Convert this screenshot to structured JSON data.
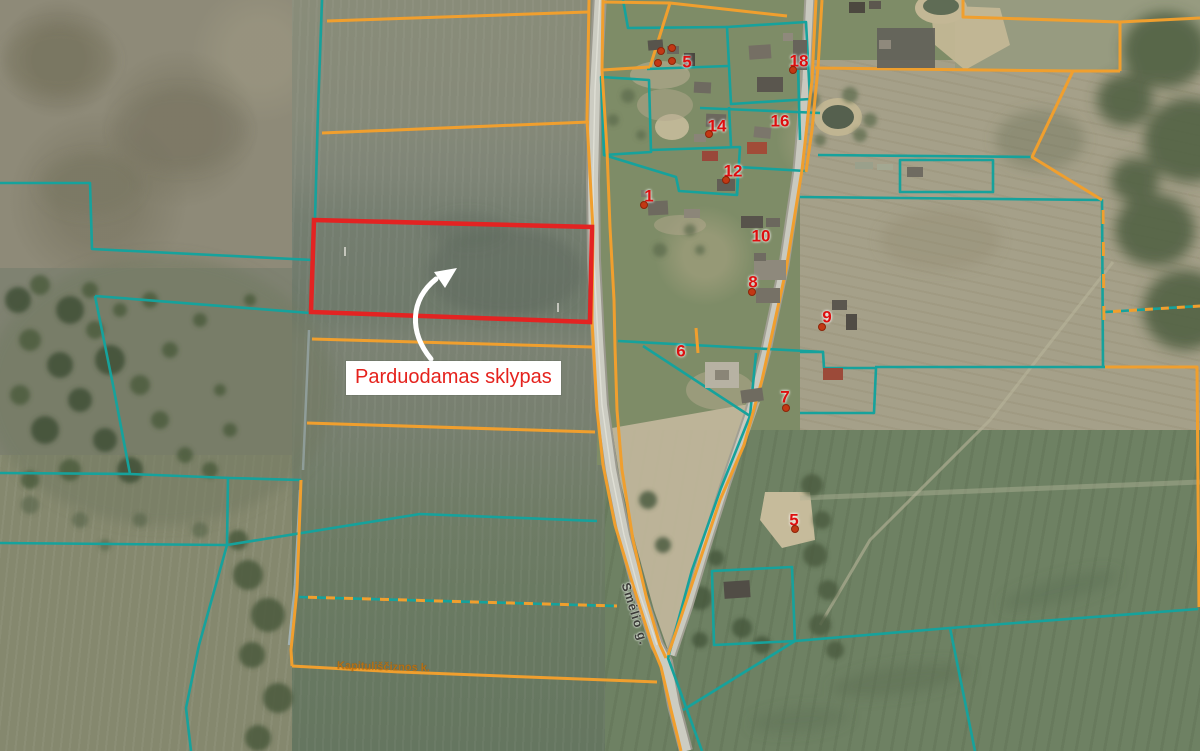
{
  "map": {
    "annotation": {
      "sale_label": "Parduodamas sklypas"
    },
    "labels": {
      "road": "Smėlio g.",
      "village": "Kapituliščiznos k."
    },
    "markers": [
      {
        "label": "5",
        "x": 687,
        "y": 63,
        "dot": {
          "x": 672,
          "y": 61
        }
      },
      {
        "label": "18",
        "x": 799,
        "y": 62,
        "dot": {
          "x": 793,
          "y": 70
        }
      },
      {
        "label": "14",
        "x": 717,
        "y": 127,
        "dot": {
          "x": 709,
          "y": 134
        }
      },
      {
        "label": "16",
        "x": 780,
        "y": 122
      },
      {
        "label": "12",
        "x": 733,
        "y": 172,
        "dot": {
          "x": 726,
          "y": 180
        }
      },
      {
        "label": "1",
        "x": 649,
        "y": 197,
        "dot": {
          "x": 644,
          "y": 205
        }
      },
      {
        "label": "10",
        "x": 761,
        "y": 237
      },
      {
        "label": "8",
        "x": 753,
        "y": 283,
        "dot": {
          "x": 752,
          "y": 292
        }
      },
      {
        "label": "9",
        "x": 827,
        "y": 318,
        "dot": {
          "x": 822,
          "y": 327
        }
      },
      {
        "label": "6",
        "x": 681,
        "y": 352
      },
      {
        "label": "7",
        "x": 785,
        "y": 398,
        "dot": {
          "x": 786,
          "y": 408
        }
      },
      {
        "label": "5",
        "x": 794,
        "y": 521,
        "dot": {
          "x": 795,
          "y": 529
        }
      }
    ],
    "extra_dots": [
      {
        "x": 661,
        "y": 51
      },
      {
        "x": 672,
        "y": 48
      },
      {
        "x": 658,
        "y": 63
      }
    ],
    "palette": {
      "parcel_red": "#e32322",
      "boundary_orange": "#f09f2e",
      "boundary_teal": "#16a29c",
      "marker_red": "#dd0f0f",
      "label_text_red": "#e5221d",
      "road_gray": "#ccccc2",
      "sand_tan": "#c3b795",
      "water_green": "#55604e"
    }
  }
}
